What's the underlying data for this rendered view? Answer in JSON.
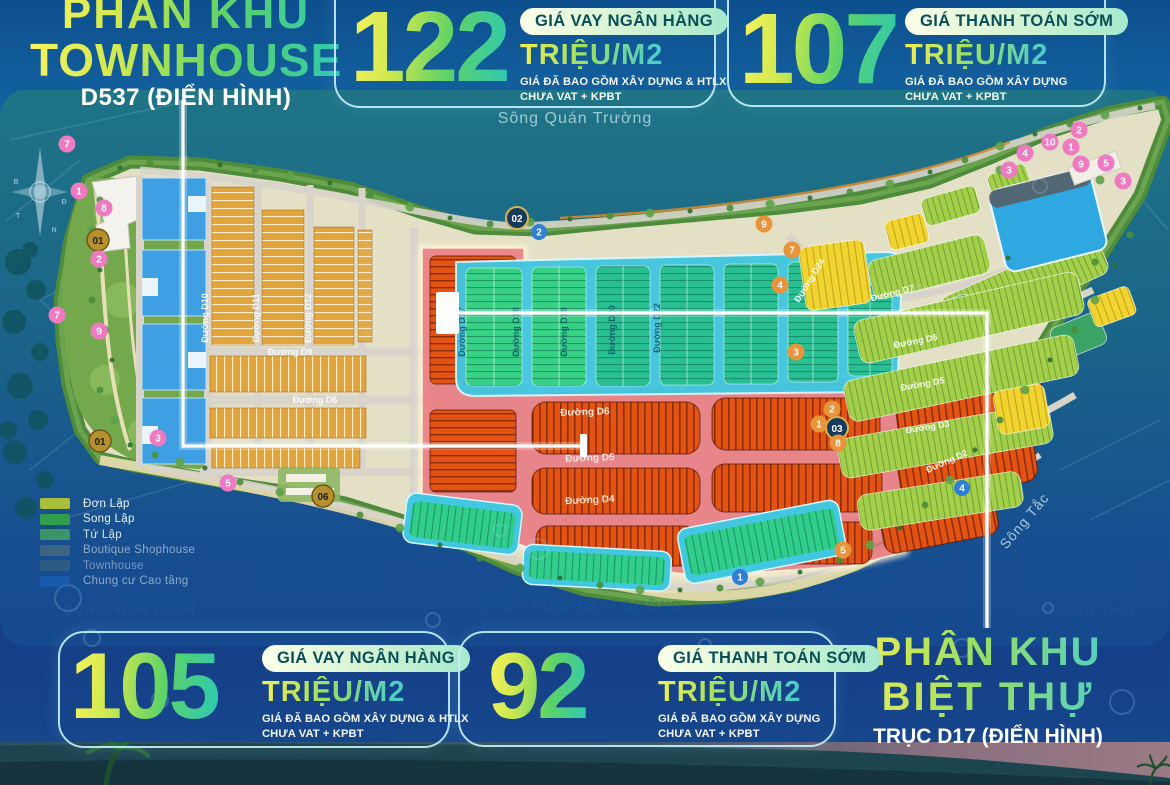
{
  "titles": {
    "townhouse": {
      "line1": "PHÂN KHU",
      "line2": "TOWNHOUSE",
      "subtitle": "D537 (ĐIỂN HÌNH)"
    },
    "villa": {
      "line1": "PHÂN KHU",
      "line2": "BIỆT THỰ",
      "subtitle": "TRỤC D17 (ĐIỂN HÌNH)"
    }
  },
  "price_cards": [
    {
      "value": "122",
      "badge": "GIÁ VAY NGÂN HÀNG",
      "unit": "TRIỆU/M2",
      "note1": "GIÁ ĐÃ BAO GỒM XÂY DỰNG & HTLX",
      "note2": "CHƯA VAT + KPBT"
    },
    {
      "value": "107",
      "badge": "GIÁ THANH TOÁN SỚM",
      "unit": "TRIỆU/M2",
      "note1": "GIÁ ĐÃ BAO GỒM XÂY DỰNG",
      "note2": "CHƯA VAT + KPBT"
    },
    {
      "value": "105",
      "badge": "GIÁ VAY NGÂN HÀNG",
      "unit": "TRIỆU/M2",
      "note1": "GIÁ ĐÃ BAO GỒM XÂY DỰNG & HTLX",
      "note2": "CHƯA VAT + KPBT"
    },
    {
      "value": "92",
      "badge": "GIÁ THANH TOÁN SỚM",
      "unit": "TRIỆU/M2",
      "note1": "GIÁ ĐÃ BAO GỒM XÂY DỰNG",
      "note2": "CHƯA VAT + KPBT"
    }
  ],
  "legend": {
    "items": [
      {
        "label": "Đơn Lập",
        "color": "#a9bf3b"
      },
      {
        "label": "Song Lập",
        "color": "#2f9e4e"
      },
      {
        "label": "Tứ Lập",
        "color": "#3f9a6a"
      },
      {
        "label": "Boutique Shophouse",
        "color": "#70876f"
      },
      {
        "label": "Townhouse",
        "color": "#5c7a70"
      },
      {
        "label": "Chung cư Cao tầng",
        "color": "#1b67cc"
      }
    ]
  },
  "map": {
    "water_labels": {
      "top_river": "Sông Quán Trường",
      "right_river": "Sông Tắc"
    },
    "faint_labels": {
      "left": "CÔNG VIÊN OSEN",
      "center": "CÔNG VIÊN NGHỈ DƯỠNG",
      "right": "ĐẬP SINH THÁI"
    },
    "streets": [
      "Đường D10",
      "Đường D11",
      "Đường D12",
      "Đường D9",
      "Đường D6",
      "Đường D17",
      "Đường D18",
      "Đường D19",
      "Đường D20",
      "Đường D22",
      "Đường D6",
      "Đường D5",
      "Đường D4",
      "Đường D24",
      "Đường D7",
      "Đường D6",
      "Đường D5",
      "Đường D3",
      "Đường D2"
    ],
    "markers": {
      "gold_badges": [
        "01",
        "01",
        "02",
        "03",
        "06"
      ],
      "pink": [
        "7",
        "1",
        "8",
        "2",
        "7",
        "9",
        "3",
        "5",
        "2",
        "10",
        "1",
        "4",
        "3",
        "9",
        "5",
        "3"
      ],
      "orange": [
        "9",
        "4",
        "7",
        "3",
        "2",
        "1",
        "8",
        "5"
      ],
      "blue": [
        "2",
        "1",
        "4"
      ]
    }
  },
  "colors": {
    "accent_yellow": "#f8f163",
    "accent_green": "#52cf6e",
    "accent_cyan": "#2ac6b9",
    "badge_text": "#0a4e58",
    "card_border": "#bfe9f5",
    "red_zone_lot": "#e35311",
    "red_zone_overlay": "#e96c78",
    "cyan_zone": "#41c7e0",
    "emerald_lot": "#2cc68e",
    "light_green_lot": "#a3cf4b",
    "yellow_lot": "#f1d42f",
    "blue_tower": "#3e9fe3",
    "water_teal": "#1f7486",
    "water_deep": "#16498f"
  }
}
